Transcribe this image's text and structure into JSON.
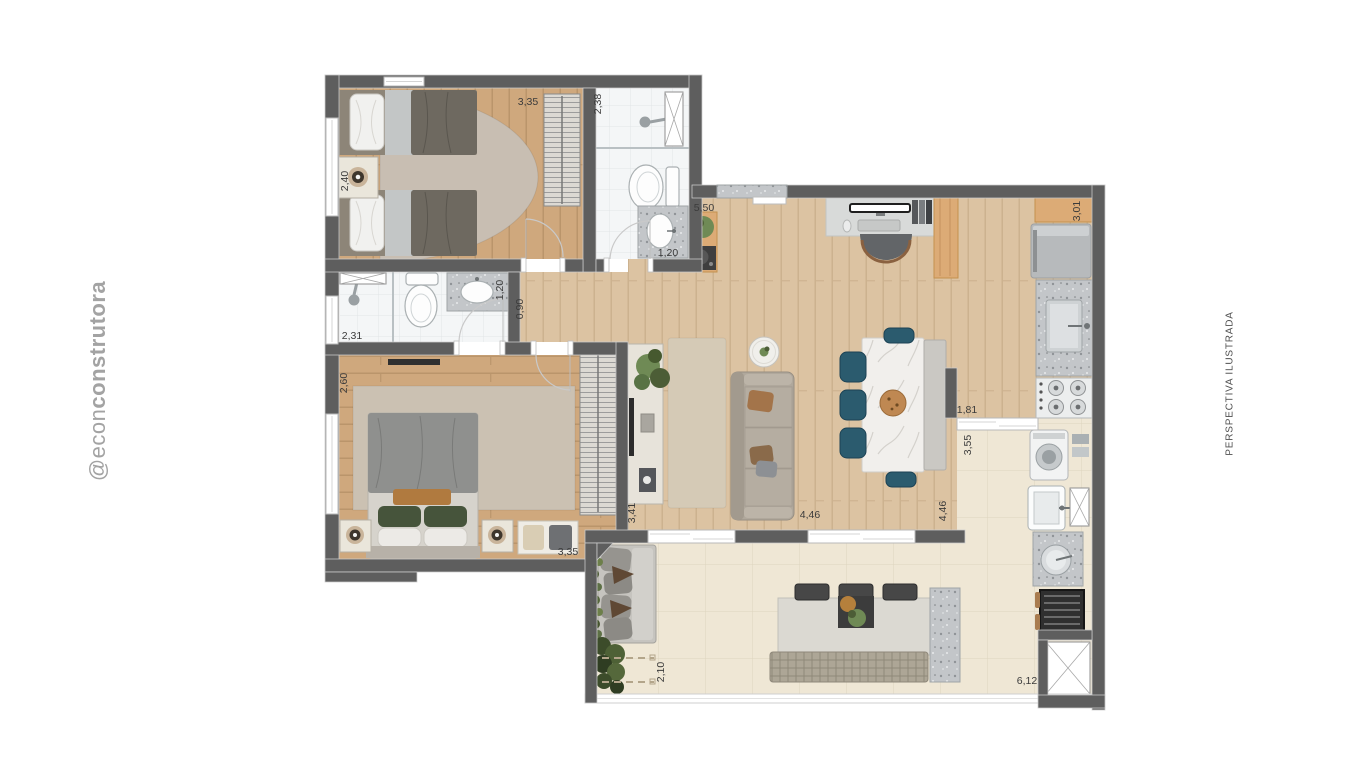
{
  "watermark": {
    "prefix": "@econ",
    "suffix": "construtora"
  },
  "side_label": "PERSPECTIVA ILUSTRADA",
  "dimensions": {
    "bedroom1_width": "3,35",
    "bath1_depth": "2,38",
    "bedroom1_depth": "2,40",
    "bath1_width": "1,20",
    "living_entry_width": "5,50",
    "kitchen_counter_depth": "3,01",
    "hall_segment": "1,20",
    "hall_width": "0,90",
    "bath2_width": "2,31",
    "master_depth": "2,60",
    "tv_wall_length": "3,41",
    "living_width": "4,46",
    "living_depth": "4,46",
    "service_passage_width": "1,81",
    "service_depth": "3,55",
    "master_width": "3,35",
    "balcony_planter_depth": "2,10",
    "balcony_width": "6,12"
  },
  "palette": {
    "wall": "#5e5e5e",
    "wood_warm": "#cfa87d",
    "wood_living": "#dcc3a2",
    "wood_accent": "#dcab76",
    "tile_outdoor": "#efe7d5",
    "tile_bath": "#f4f6f7",
    "granite": "#c3c6c9",
    "marble": "#f1efec",
    "teal": "#2b5b6e",
    "rug_living": "#d5cab6",
    "rug_bedroom": "#c8beb2",
    "rug_master": "#cbc1b2",
    "sofa": "#b0a89c",
    "outdoor_sofa": "#c6c4bf",
    "blanket": "#6e6960",
    "duvet": "#8f908e",
    "cream": "#eae6db",
    "plant_dark": "#4c5d36",
    "plant_mid": "#6f8a55",
    "pillow_green": "#46543b",
    "pillow_orange": "#b07a3f",
    "dim_text": "#3b3b3b",
    "watermark_text": "#a3a3a3",
    "side_text": "#4f4f4f"
  }
}
